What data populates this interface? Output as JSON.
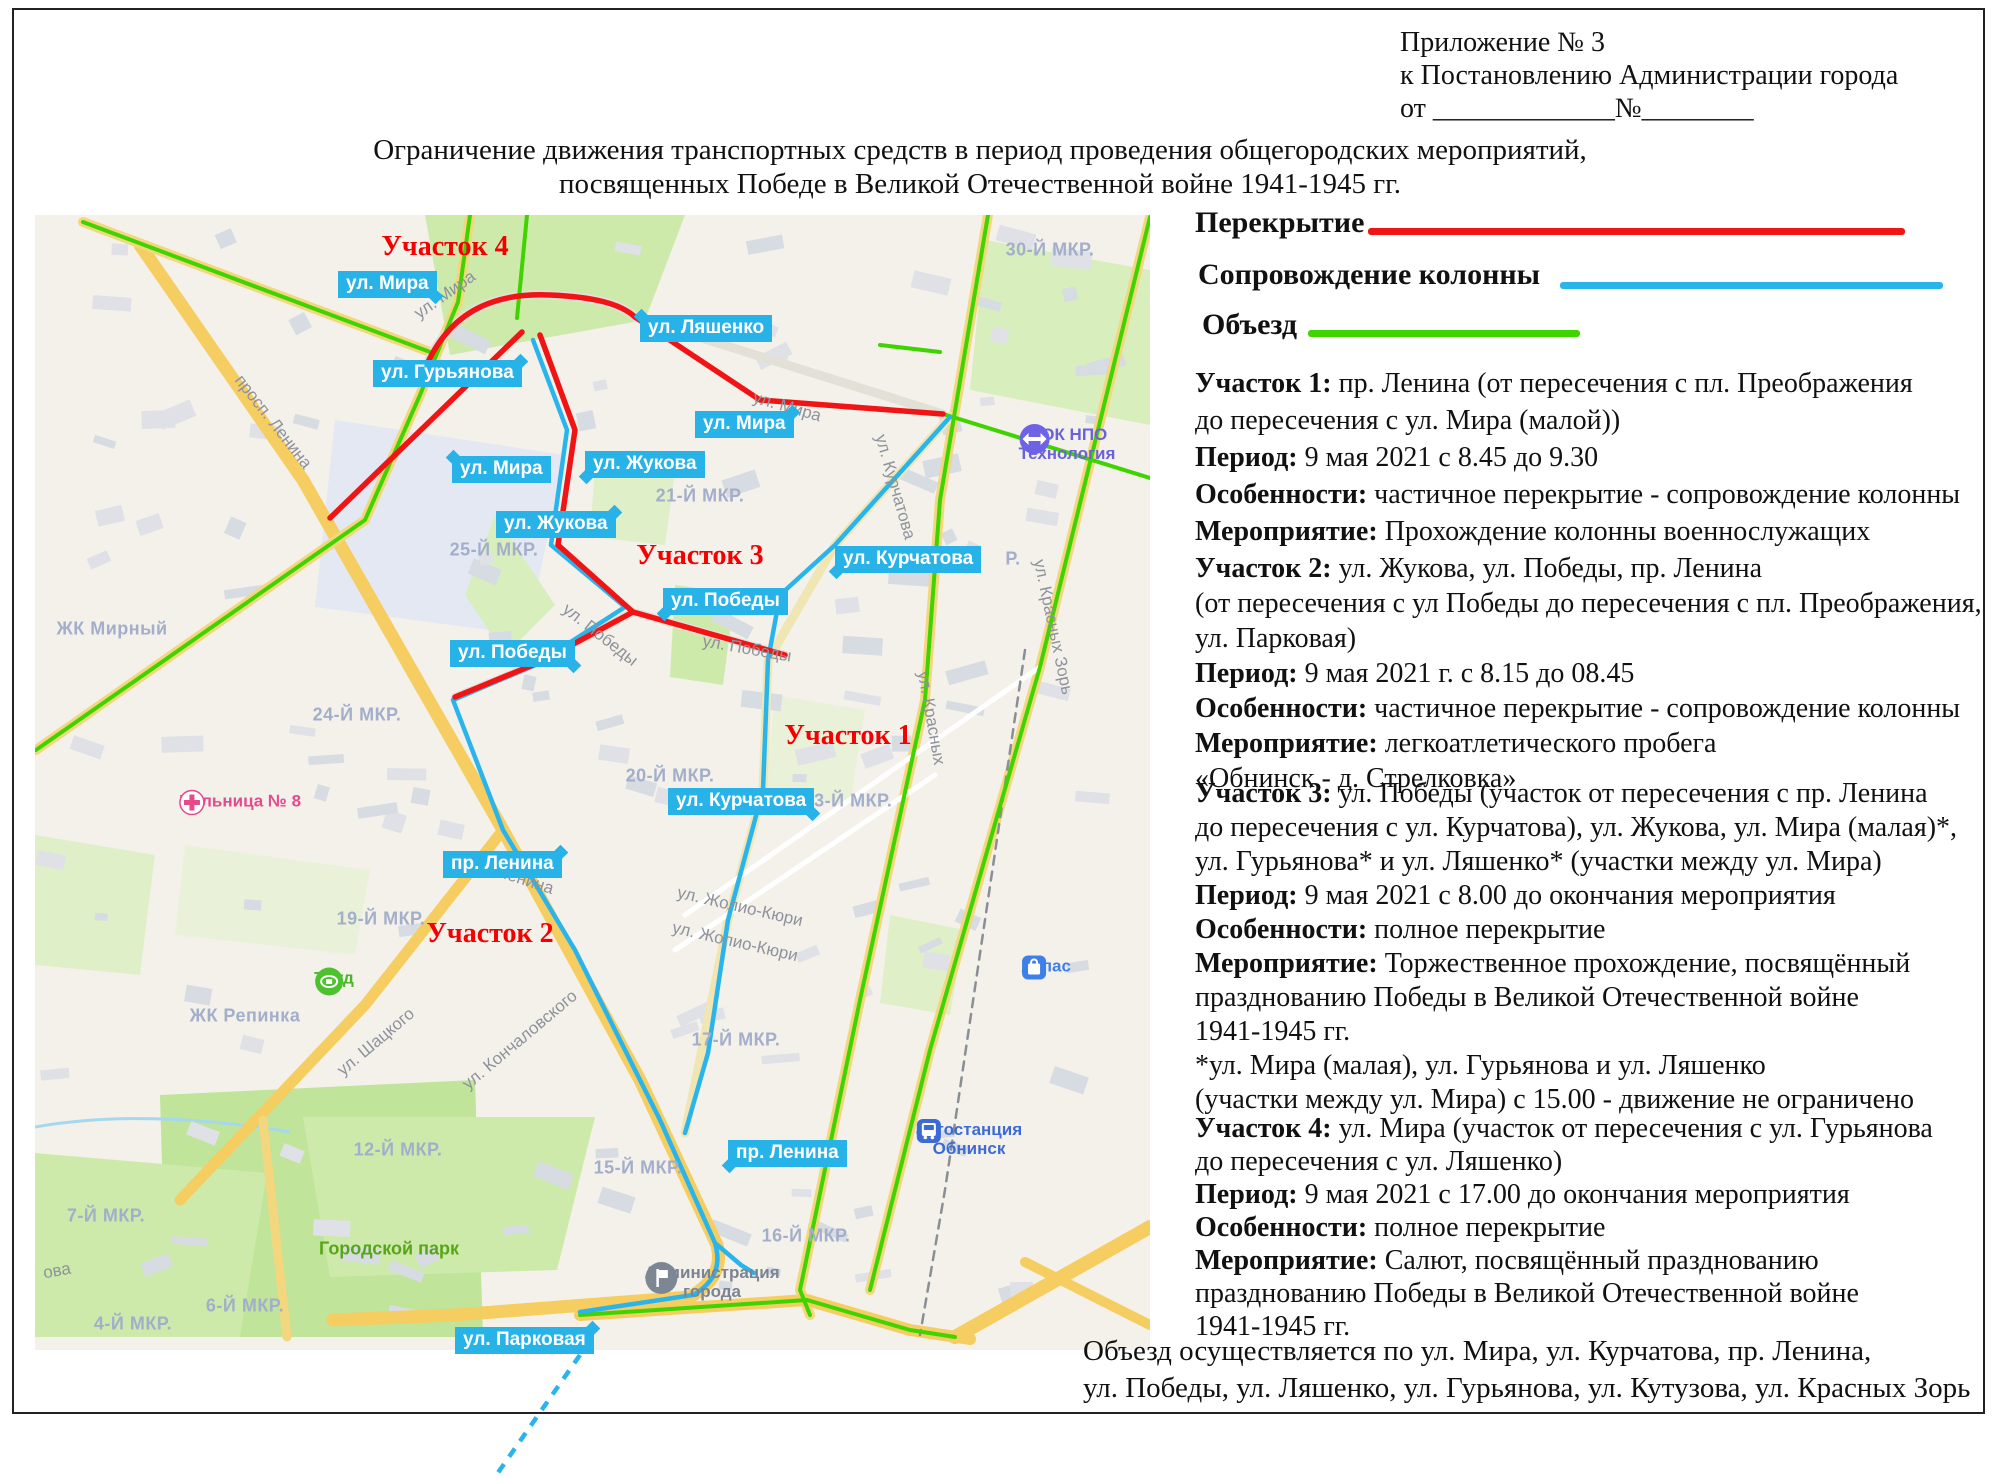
{
  "header": {
    "annex_lines": [
      "Приложение № 3",
      "к Постановлению Администрации города",
      "от _____________№________"
    ],
    "title_line1": "Ограничение движения транспортных средств в период проведения общегородских мероприятий,",
    "title_line2": "посвященных Победе в Великой Отечественной войне 1941-1945 гг."
  },
  "colors": {
    "closure": "#f01414",
    "escort": "#2ab4ec",
    "detour": "#3fd400",
    "badge": "#27b2e8"
  },
  "legend": [
    {
      "label": "Перекрытие",
      "color": "#f01414"
    },
    {
      "label": "Сопровождение колонны",
      "color": "#2ab4ec"
    },
    {
      "label": "Объезд",
      "color": "#3fd400"
    }
  ],
  "sections": [
    {
      "lines": [
        [
          {
            "b": 1,
            "t": "Участок 1:"
          },
          {
            "t": " пр. Ленина (от пересечения с пл. Преображения"
          }
        ],
        [
          {
            "t": "до пересечения с ул. Мира (малой))"
          }
        ],
        [
          {
            "b": 1,
            "t": "Период:"
          },
          {
            "t": " 9 мая 2021 с 8.45 до 9.30"
          }
        ],
        [
          {
            "b": 1,
            "t": "Особенности:"
          },
          {
            "t": " частичное перекрытие - сопровождение колонны"
          }
        ],
        [
          {
            "b": 1,
            "t": "Мероприятие:"
          },
          {
            "t": " Прохождение колонны военнослужащих"
          }
        ]
      ]
    },
    {
      "lines": [
        [
          {
            "b": 1,
            "t": "Участок 2:"
          },
          {
            "t": " ул. Жукова, ул. Победы, пр. Ленина"
          }
        ],
        [
          {
            "t": "(от пересечения с ул Победы до пересечения с пл. Преображения,"
          }
        ],
        [
          {
            "t": "ул. Парковая)"
          }
        ],
        [
          {
            "b": 1,
            "t": "Период:"
          },
          {
            "t": " 9 мая 2021 г. с 8.15 до 08.45"
          }
        ],
        [
          {
            "b": 1,
            "t": "Особенности:"
          },
          {
            "t": " частичное перекрытие - сопровождение колонны"
          }
        ],
        [
          {
            "b": 1,
            "t": "Мероприятие:"
          },
          {
            "t": "  легкоатлетического пробега"
          }
        ],
        [
          {
            "t": "«Обнинск - д. Стрелковка»"
          }
        ]
      ]
    },
    {
      "lines": [
        [
          {
            "b": 1,
            "t": "Участок 3:"
          },
          {
            "t": " ул. Победы (участок от пересечения с пр. Ленина"
          }
        ],
        [
          {
            "t": " до пересечения с ул. Курчатова), ул. Жукова, ул. Мира (малая)*,"
          }
        ],
        [
          {
            "t": "ул. Гурьянова* и ул. Ляшенко* (участки между ул. Мира)"
          }
        ],
        [
          {
            "b": 1,
            "t": "Период:"
          },
          {
            "t": " 9 мая 2021 с 8.00 до окончания мероприятия"
          }
        ],
        [
          {
            "b": 1,
            "t": "Особенности:"
          },
          {
            "t": " полное перекрытие"
          }
        ],
        [
          {
            "b": 1,
            "t": "Мероприятие:"
          },
          {
            "t": " Торжественное прохождение, посвящённый"
          }
        ],
        [
          {
            "t": "празднованию Победы в Великой Отечественной войне"
          }
        ],
        [
          {
            "t": "1941-1945 гг."
          }
        ],
        [
          {
            "t": "*ул. Мира (малая), ул. Гурьянова и ул. Ляшенко"
          }
        ],
        [
          {
            "t": "(участки между ул. Мира) с 15.00 - движение не ограничено"
          }
        ]
      ]
    },
    {
      "lines": [
        [
          {
            "b": 1,
            "t": "Участок 4:"
          },
          {
            "t": " ул. Мира (участок от пересечения с ул. Гурьянова"
          }
        ],
        [
          {
            "t": "до пересечения с ул. Ляшенко)"
          }
        ],
        [
          {
            "b": 1,
            "t": "Период:"
          },
          {
            "t": " 9 мая 2021 с 17.00 до окончания мероприятия"
          }
        ],
        [
          {
            "b": 1,
            "t": "Особенности:"
          },
          {
            "t": " полное перекрытие"
          }
        ],
        [
          {
            "b": 1,
            "t": "Мероприятие:"
          },
          {
            "t": " Салют, посвящённый празднованию"
          }
        ],
        [
          {
            "t": "празднованию Победы в Великой Отечественной войне"
          }
        ],
        [
          {
            "t": "1941-1945 гг."
          }
        ]
      ]
    }
  ],
  "detour_note": [
    "Объезд осуществляется по ул. Мира, ул. Курчатова, пр. Ленина,",
    "ул. Победы, ул. Ляшенко, ул. Гурьянова, ул. Кутузова, ул. Красных Зорь"
  ],
  "map": {
    "section_labels": [
      {
        "text": "Участок 4",
        "x": 410,
        "y": 32
      },
      {
        "text": "Участок 3",
        "x": 665,
        "y": 341
      },
      {
        "text": "Участок 1",
        "x": 813,
        "y": 521
      },
      {
        "text": "Участок 2",
        "x": 455,
        "y": 719
      }
    ],
    "street_badges": [
      {
        "text": "ул. Мира",
        "x": 303,
        "y": 56,
        "tail": "br"
      },
      {
        "text": "ул. Ляшенко",
        "x": 605,
        "y": 100,
        "tail": "tl"
      },
      {
        "text": "ул. Гурьянова",
        "x": 338,
        "y": 145,
        "tail": "tr"
      },
      {
        "text": "ул. Мира",
        "x": 660,
        "y": 196,
        "tail": "tr"
      },
      {
        "text": "ул. Мира",
        "x": 417,
        "y": 241,
        "tail": "tl"
      },
      {
        "text": "ул. Жукова",
        "x": 550,
        "y": 236,
        "tail": "bl"
      },
      {
        "text": "ул. Жукова",
        "x": 461,
        "y": 296,
        "tail": "tr"
      },
      {
        "text": "ул. Курчатова",
        "x": 800,
        "y": 331,
        "tail": "bl"
      },
      {
        "text": "ул. Победы",
        "x": 628,
        "y": 373,
        "tail": "bl"
      },
      {
        "text": "ул. Победы",
        "x": 415,
        "y": 425,
        "tail": "br"
      },
      {
        "text": "ул. Курчатова",
        "x": 633,
        "y": 573,
        "tail": "br"
      },
      {
        "text": "пр. Ленина",
        "x": 408,
        "y": 636,
        "tail": "tr"
      },
      {
        "text": "пр. Ленина",
        "x": 693,
        "y": 925,
        "tail": "bl"
      },
      {
        "text": "ул. Парковая",
        "x": 420,
        "y": 1112,
        "tail": "tr"
      }
    ],
    "area_labels": [
      {
        "text": "30-Й МКР.",
        "x": 1015,
        "y": 35
      },
      {
        "text": "21-Й МКР.",
        "x": 665,
        "y": 281
      },
      {
        "text": "25-Й МКР.",
        "x": 459,
        "y": 335
      },
      {
        "text": "Р.",
        "x": 978,
        "y": 344
      },
      {
        "text": "ЖК Мирный",
        "x": 77,
        "y": 414
      },
      {
        "text": "24-Й МКР.",
        "x": 322,
        "y": 500
      },
      {
        "text": "20-Й МКР.",
        "x": 635,
        "y": 561
      },
      {
        "text": "23-Й МКР.",
        "x": 813,
        "y": 586
      },
      {
        "text": "19-Й МКР.",
        "x": 346,
        "y": 704
      },
      {
        "text": "ЖК Репинка",
        "x": 210,
        "y": 801
      },
      {
        "text": "17-Й МКР.",
        "x": 701,
        "y": 825
      },
      {
        "text": "12-Й МКР.",
        "x": 363,
        "y": 935
      },
      {
        "text": "15-Й МКР.",
        "x": 603,
        "y": 953
      },
      {
        "text": "7-Й МКР.",
        "x": 71,
        "y": 1001
      },
      {
        "text": "16-Й МКР.",
        "x": 771,
        "y": 1021
      },
      {
        "text": "6-Й МКР.",
        "x": 210,
        "y": 1091
      },
      {
        "text": "4-Й МКР.",
        "x": 98,
        "y": 1109
      }
    ],
    "park_labels": [
      {
        "text": "Городской парк",
        "x": 354,
        "y": 1034
      }
    ],
    "street_names": [
      {
        "text": "ул. Мира",
        "x": 410,
        "y": 80,
        "rot": -35
      },
      {
        "text": "ул. Мира",
        "x": 752,
        "y": 192,
        "rot": 16
      },
      {
        "text": "просп. Ленина",
        "x": 238,
        "y": 207,
        "rot": 52
      },
      {
        "text": "ул. Курчатова",
        "x": 860,
        "y": 272,
        "rot": 74
      },
      {
        "text": "ул. Красных Зорь",
        "x": 1018,
        "y": 412,
        "rot": 78
      },
      {
        "text": "ул. Красных",
        "x": 896,
        "y": 503,
        "rot": 80
      },
      {
        "text": "ул. Победы",
        "x": 565,
        "y": 420,
        "rot": 38
      },
      {
        "text": "ул. Победы",
        "x": 712,
        "y": 434,
        "rot": 10
      },
      {
        "text": "пр. Ленина",
        "x": 477,
        "y": 661,
        "rot": 18
      },
      {
        "text": "ул. Жолио-Кюри",
        "x": 705,
        "y": 692,
        "rot": 13
      },
      {
        "text": "ул. Жолио-Кюри",
        "x": 700,
        "y": 727,
        "rot": 13
      },
      {
        "text": "ул. Шацкого",
        "x": 341,
        "y": 827,
        "rot": -40
      },
      {
        "text": "ул. Кончаловского",
        "x": 485,
        "y": 825,
        "rot": -40
      },
      {
        "text": "ова",
        "x": 22,
        "y": 1056,
        "rot": -10
      }
    ],
    "places": [
      {
        "type": "hospital",
        "icon": "hospital-cross-icon",
        "lines": [
          "Больница № 8"
        ],
        "x": 205,
        "y": 585,
        "color": "#e64a8d"
      },
      {
        "type": "stadium",
        "icon": "stadium-icon",
        "lines": [
          "Труд"
        ],
        "x": 299,
        "y": 762,
        "color": "#4db32a"
      },
      {
        "type": "sport",
        "icon": "arrows-icon",
        "lines": [
          "ФОК НПО",
          "Технология"
        ],
        "x": 1032,
        "y": 228,
        "color": "#6a63d8"
      },
      {
        "type": "shop",
        "icon": "bag-icon",
        "lines": [
          "Атлас"
        ],
        "x": 1011,
        "y": 750,
        "color": "#3f7fe8"
      },
      {
        "type": "bus",
        "icon": "bus-icon",
        "lines": [
          "автостанция",
          "Обнинск"
        ],
        "x": 934,
        "y": 923,
        "color": "#3d6bd6"
      },
      {
        "type": "admin",
        "icon": "flag-icon",
        "lines": [
          "Администрация",
          "города"
        ],
        "x": 677,
        "y": 1066,
        "color": "#7b8492"
      }
    ],
    "routes": {
      "red": [
        "M393,147 C420,90 468,78 515,80 C560,82 586,89 600,102",
        "M600,102 L725,185 L908,199",
        "M295,303 L487,117",
        "M505,120 L540,215 L523,330 L598,397",
        "M598,397 L750,440",
        "M598,397 L505,447 L420,482"
      ],
      "blue": [
        "M498,125 L532,215 L516,330 L590,392 L500,450 L418,485 L468,615 L540,735 L625,905 L680,1028 Q690,1062 658,1080 L545,1097",
        "M915,202 L800,330 L745,380 L733,445 L728,575 L693,705 L673,838 L650,918",
        "M680,1028 L706,1050 L719,1058"
      ],
      "green": [
        "M48,7 L395,137",
        "M435,0 L423,87 L385,180 L330,305 L1,535",
        "M492,0 L482,103",
        "M953,0 L905,285 L890,485 L825,785 L765,1075 L775,1100",
        "M1115,2 L1005,452 L895,835 L835,1075",
        "M845,130 L905,137",
        "M908,199 L1115,263",
        "M772,1085 L545,1100",
        "M772,1085 L875,1115 L920,1122"
      ],
      "blue_dashed": "M545,1140 L460,1262"
    }
  }
}
